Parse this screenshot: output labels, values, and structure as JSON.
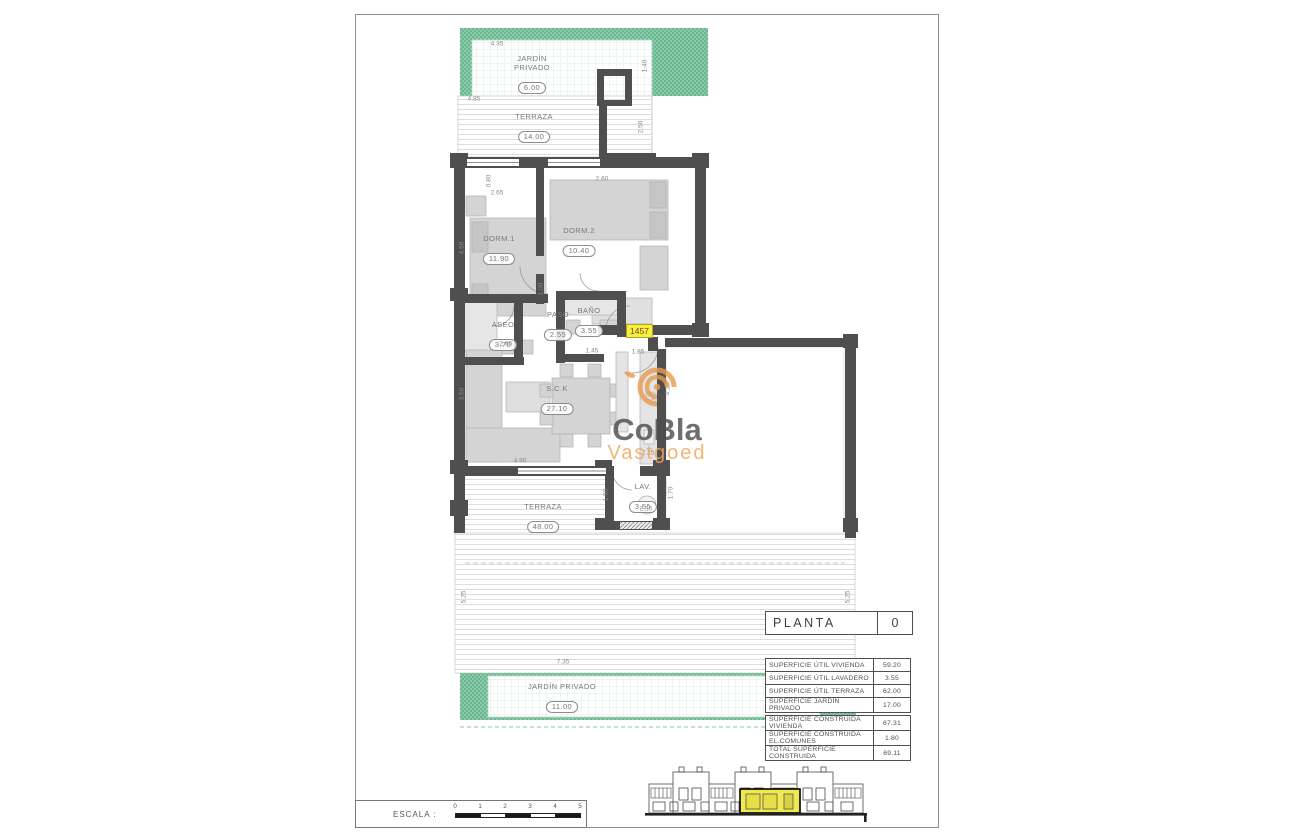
{
  "document": {
    "type_label": "PLANTA",
    "type_value": "0"
  },
  "watermark": {
    "brand": "CoBla",
    "sub": "Vastgoed",
    "logo_color": "#e89b4e",
    "brand_color": "#4f4f4f",
    "sub_color": "#f0a85c"
  },
  "unit_tag": {
    "text": "1457",
    "bg": "#f4ef46"
  },
  "scale_bar": {
    "label": "ESCALA :",
    "ticks": [
      "0",
      "1",
      "2",
      "3",
      "4",
      "5"
    ]
  },
  "tables": {
    "areas_utiles": {
      "rows": [
        {
          "label": "SUPERFICIE ÚTIL VIVIENDA",
          "value": "59.20"
        },
        {
          "label": "SUPERFICIE ÚTIL LAVADERO",
          "value": "3.55"
        },
        {
          "label": "SUPERFICIE ÚTIL TERRAZA",
          "value": "62.00"
        },
        {
          "label": "SUPERFICIE JARDÍN PRIVADO",
          "value": "17.00"
        }
      ]
    },
    "areas_construidas": {
      "rows": [
        {
          "label": "SUPERFICIE CONSTRUIDA VIVIENDA",
          "value": "67.31"
        },
        {
          "label": "SUPERFICIE CONSTRUIDA EL.COMUNES",
          "value": "1.80"
        },
        {
          "label": "TOTAL SUPERFICIE CONSTRUIDA",
          "value": "69.11"
        }
      ]
    }
  },
  "plan": {
    "colors": {
      "wall": "#4f4f4f",
      "garden_green": "#85c7a4",
      "garden_dot": "#6bb591",
      "hatch_line": "#dadada",
      "furniture": "#d4d4d4",
      "dim_text": "#8a8a8a",
      "room_text": "#787878",
      "highlight_yellow": "#efe84e"
    },
    "rooms": [
      {
        "id": "jardin-privado-norte",
        "lines": [
          "JARDÍN",
          "PRIVADO"
        ],
        "value": "6.00",
        "x": 532,
        "y": 54
      },
      {
        "id": "terraza-norte",
        "lines": [
          "TERRAZA"
        ],
        "value": "14.00",
        "x": 534,
        "y": 112
      },
      {
        "id": "dormitorio-1",
        "lines": [
          "DORM.1"
        ],
        "value": "11.90",
        "x": 499,
        "y": 234
      },
      {
        "id": "dormitorio-2",
        "lines": [
          "DORM.2"
        ],
        "value": "10.40",
        "x": 579,
        "y": 226
      },
      {
        "id": "aseo",
        "lines": [
          "ASEO"
        ],
        "value": "3.70",
        "x": 503,
        "y": 320
      },
      {
        "id": "paso",
        "lines": [
          "PASO"
        ],
        "value": "2.55",
        "x": 558,
        "y": 310
      },
      {
        "id": "bano",
        "lines": [
          "BAÑO"
        ],
        "value": "3.55",
        "x": 589,
        "y": 306
      },
      {
        "id": "salon-cocina",
        "lines": [
          "S.C.K"
        ],
        "value": "27.10",
        "x": 557,
        "y": 384
      },
      {
        "id": "lavadero",
        "lines": [
          "LAV."
        ],
        "value": "3.55",
        "x": 643,
        "y": 482
      },
      {
        "id": "terraza-sur",
        "lines": [
          "TERRAZA"
        ],
        "value": "48.00",
        "x": 543,
        "y": 502
      },
      {
        "id": "jardin-privado-sur",
        "lines": [
          "JARDÍN  PRIVADO"
        ],
        "value": "11.00",
        "x": 562,
        "y": 682
      }
    ],
    "dims": [
      {
        "t": "4.35",
        "x": 497,
        "y": 44
      },
      {
        "t": "1.40",
        "x": 645,
        "y": 66,
        "v": 1
      },
      {
        "t": "4.85",
        "x": 474,
        "y": 99
      },
      {
        "t": "2.50",
        "x": 641,
        "y": 127,
        "v": 1
      },
      {
        "t": "0.80",
        "x": 489,
        "y": 181,
        "v": 1
      },
      {
        "t": "2.60",
        "x": 602,
        "y": 179
      },
      {
        "t": "2.65",
        "x": 497,
        "y": 193
      },
      {
        "t": "4.50",
        "x": 462,
        "y": 248,
        "v": 1
      },
      {
        "t": "1.00",
        "x": 541,
        "y": 289,
        "v": 1
      },
      {
        "t": "2.65",
        "x": 506,
        "y": 344
      },
      {
        "t": "1.45",
        "x": 592,
        "y": 351
      },
      {
        "t": "1.85",
        "x": 638,
        "y": 352
      },
      {
        "t": "3.50",
        "x": 462,
        "y": 394,
        "v": 1
      },
      {
        "t": "4.10",
        "x": 668,
        "y": 389,
        "v": 1
      },
      {
        "t": "4.90",
        "x": 520,
        "y": 461
      },
      {
        "t": "2.25",
        "x": 648,
        "y": 453
      },
      {
        "t": "1.90",
        "x": 606,
        "y": 495,
        "v": 1
      },
      {
        "t": "1.70",
        "x": 671,
        "y": 493,
        "v": 1
      },
      {
        "t": "2.10",
        "x": 646,
        "y": 509
      },
      {
        "t": "5.25",
        "x": 464,
        "y": 597,
        "v": 1
      },
      {
        "t": "5.25",
        "x": 848,
        "y": 597,
        "v": 1
      },
      {
        "t": "7.35",
        "x": 563,
        "y": 662
      }
    ]
  }
}
